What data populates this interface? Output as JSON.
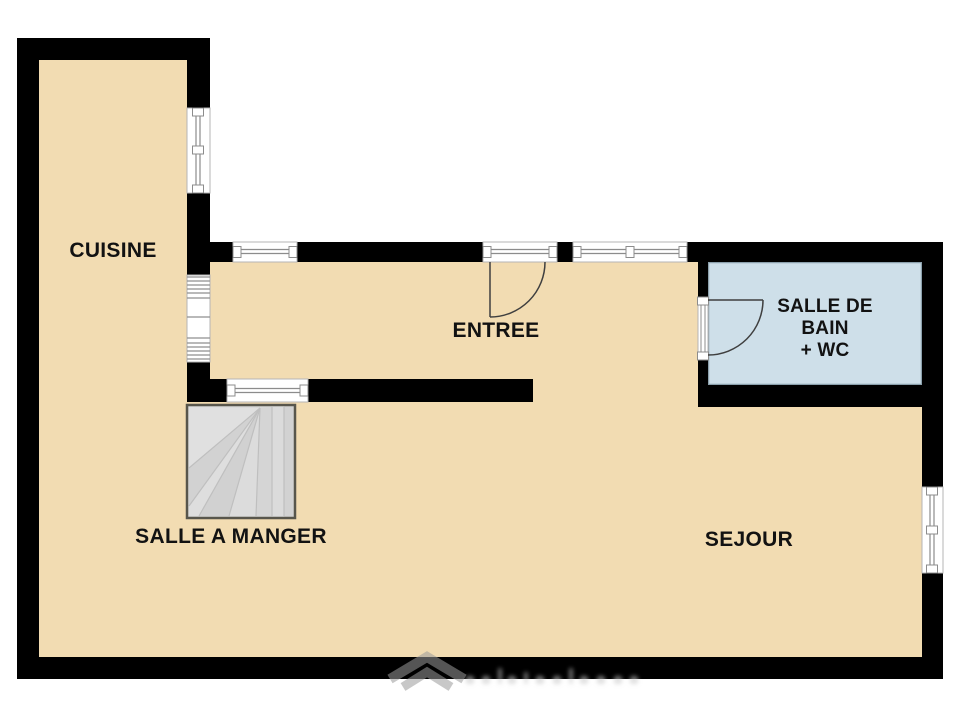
{
  "floor_plan": {
    "rooms": {
      "cuisine": {
        "label": "CUISINE"
      },
      "entree": {
        "label": "ENTREE"
      },
      "salle_de_bain": {
        "lines": [
          "SALLE DE",
          "BAIN",
          "+ WC"
        ]
      },
      "salle_a_manger": {
        "label": "SALLE A MANGER"
      },
      "sejour": {
        "label": "SEJOUR"
      }
    },
    "colors": {
      "wall": "#000000",
      "floor": "#f2dcb2",
      "bathroom_floor": "#cedfe9",
      "bathroom_border": "#8ba0ac",
      "stairs_fill": "#d8d8d8",
      "stairs_border": "#58564c",
      "window_line": "#8c8c8c",
      "door_arc": "#3f3f3f",
      "watermark_gray": "#9c9c9c"
    },
    "watermark": {
      "icon": "house-chevron-logo"
    }
  }
}
